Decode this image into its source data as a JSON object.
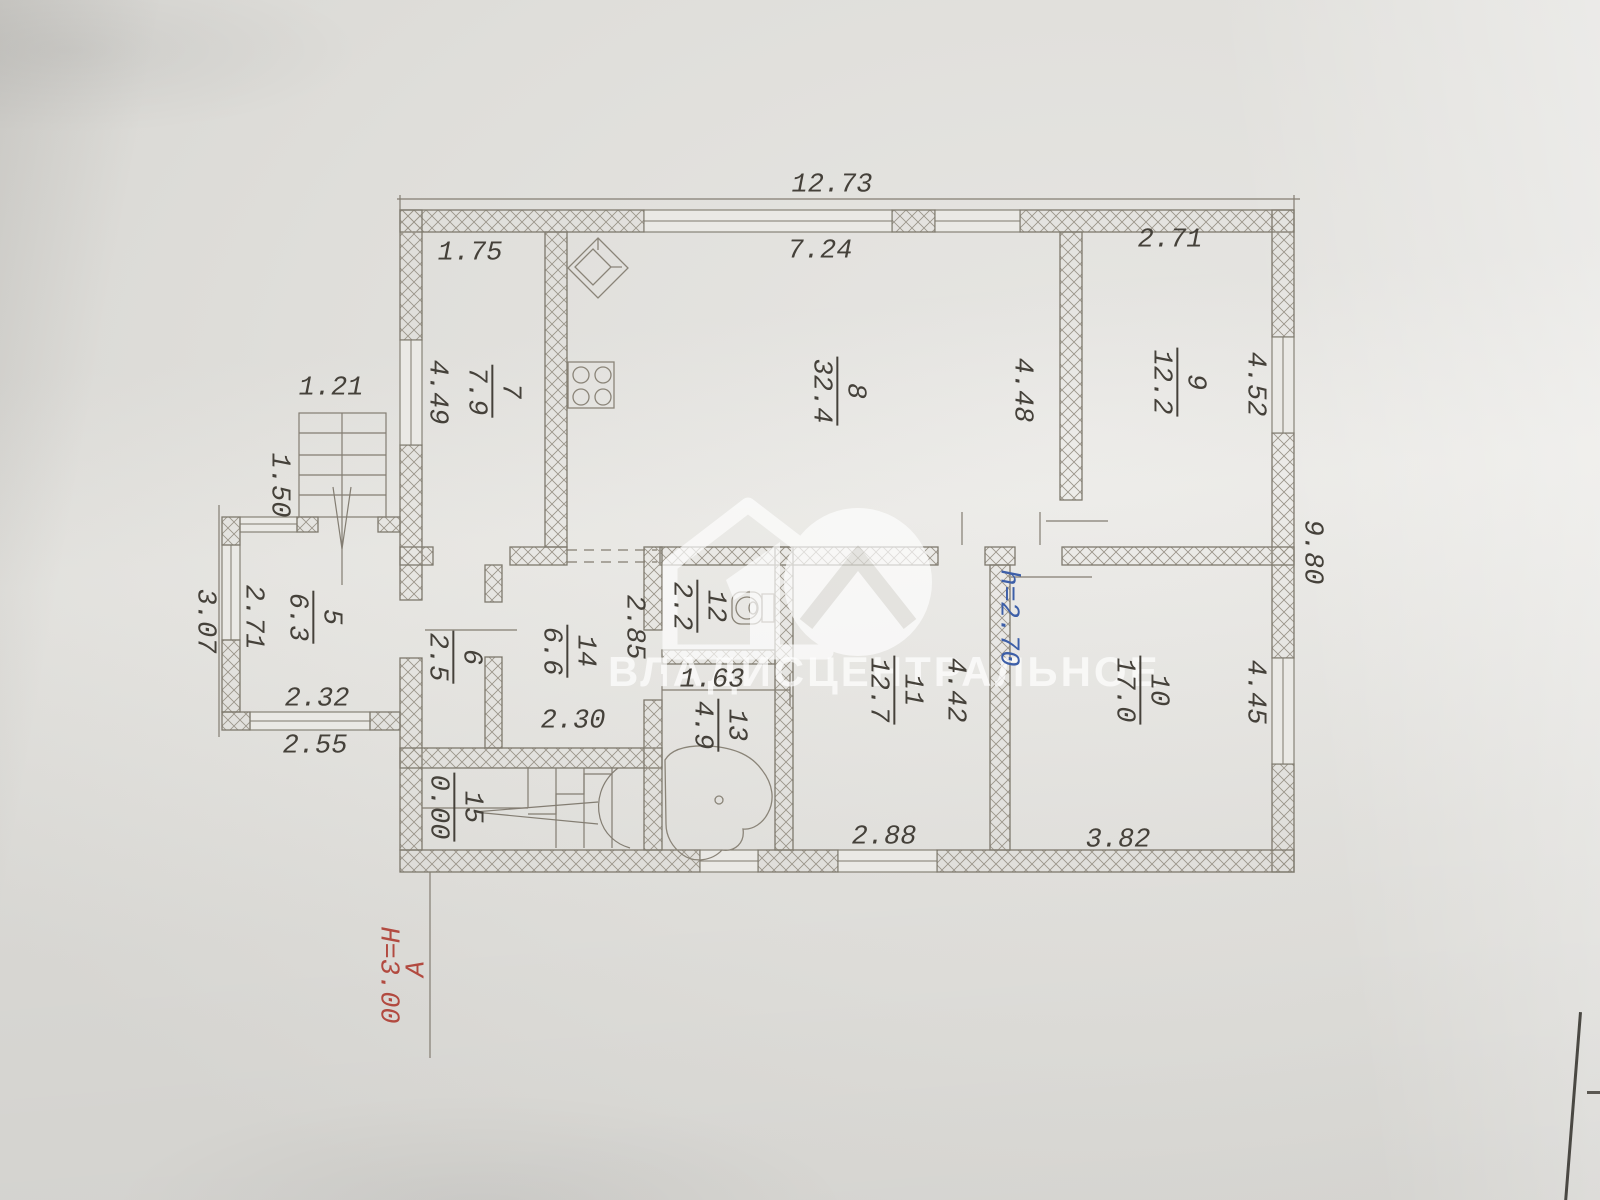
{
  "watermark": {
    "logo_number": "10",
    "brand": "ВЛАДИСЦЕНТРАЛЬНОЕ"
  },
  "plan": {
    "colors": {
      "ink": "#45413a",
      "blue_note": "#3d5fa8",
      "red_note": "#b24a40",
      "paper": "#e6e5e1",
      "wall_line": "#7e796d"
    },
    "overall_dimensions": {
      "top_width": "12.73",
      "right_height": "9.80"
    },
    "notes": {
      "ceiling_height": "h=2.70",
      "section_height": "H=3.00",
      "axis_letter": "А"
    },
    "rooms": [
      {
        "num": "7",
        "area": "7.9",
        "x": 492,
        "y": 391
      },
      {
        "num": "8",
        "area": "32.4",
        "x": 837,
        "y": 391
      },
      {
        "num": "9",
        "area": "12.2",
        "x": 1177,
        "y": 382
      },
      {
        "num": "5",
        "area": "6.3",
        "x": 313,
        "y": 617
      },
      {
        "num": "6",
        "area": "2.5",
        "x": 453,
        "y": 657
      },
      {
        "num": "14",
        "area": "6.6",
        "x": 567,
        "y": 651
      },
      {
        "num": "12",
        "area": "2.2",
        "x": 697,
        "y": 606
      },
      {
        "num": "13",
        "area": "4.9",
        "x": 718,
        "y": 725
      },
      {
        "num": "11",
        "area": "12.7",
        "x": 894,
        "y": 690
      },
      {
        "num": "10",
        "area": "17.0",
        "x": 1140,
        "y": 690
      },
      {
        "num": "15",
        "area": "0.00",
        "x": 454,
        "y": 807
      }
    ],
    "dims": [
      {
        "t": "12.73",
        "x": 832,
        "y": 186,
        "r": 0
      },
      {
        "t": "1.75",
        "x": 470,
        "y": 254,
        "r": 0
      },
      {
        "t": "7.24",
        "x": 820,
        "y": 252,
        "r": 0
      },
      {
        "t": "2.71",
        "x": 1170,
        "y": 241,
        "r": 0
      },
      {
        "t": "1.21",
        "x": 331,
        "y": 389,
        "r": 0
      },
      {
        "t": "1.50",
        "x": 278,
        "y": 485,
        "r": 90
      },
      {
        "t": "4.49",
        "x": 436,
        "y": 392,
        "r": 90
      },
      {
        "t": "4.48",
        "x": 1021,
        "y": 390,
        "r": 90
      },
      {
        "t": "4.52",
        "x": 1254,
        "y": 384,
        "r": 90
      },
      {
        "t": "9.80",
        "x": 1311,
        "y": 552,
        "r": 90
      },
      {
        "t": "3.07",
        "x": 204,
        "y": 621,
        "r": 90
      },
      {
        "t": "2.71",
        "x": 252,
        "y": 617,
        "r": 90
      },
      {
        "t": "2.32",
        "x": 317,
        "y": 700,
        "r": 0
      },
      {
        "t": "2.55",
        "x": 315,
        "y": 747,
        "r": 0
      },
      {
        "t": "2.85",
        "x": 633,
        "y": 627,
        "r": 90
      },
      {
        "t": "2.30",
        "x": 573,
        "y": 722,
        "r": 0
      },
      {
        "t": "1.63",
        "x": 712,
        "y": 681,
        "r": 0
      },
      {
        "t": "2.88",
        "x": 884,
        "y": 838,
        "r": 0
      },
      {
        "t": "3.82",
        "x": 1118,
        "y": 841,
        "r": 0
      },
      {
        "t": "4.42",
        "x": 954,
        "y": 690,
        "r": 90
      },
      {
        "t": "4.45",
        "x": 1254,
        "y": 692,
        "r": 90
      },
      {
        "t": "h=2.70",
        "x": 1007,
        "y": 618,
        "r": 90,
        "c": "blue"
      },
      {
        "t": "H=3.00",
        "x": 387,
        "y": 975,
        "r": 90,
        "c": "red"
      },
      {
        "t": "А",
        "x": 418,
        "y": 969,
        "r": -90,
        "c": "red"
      }
    ]
  }
}
